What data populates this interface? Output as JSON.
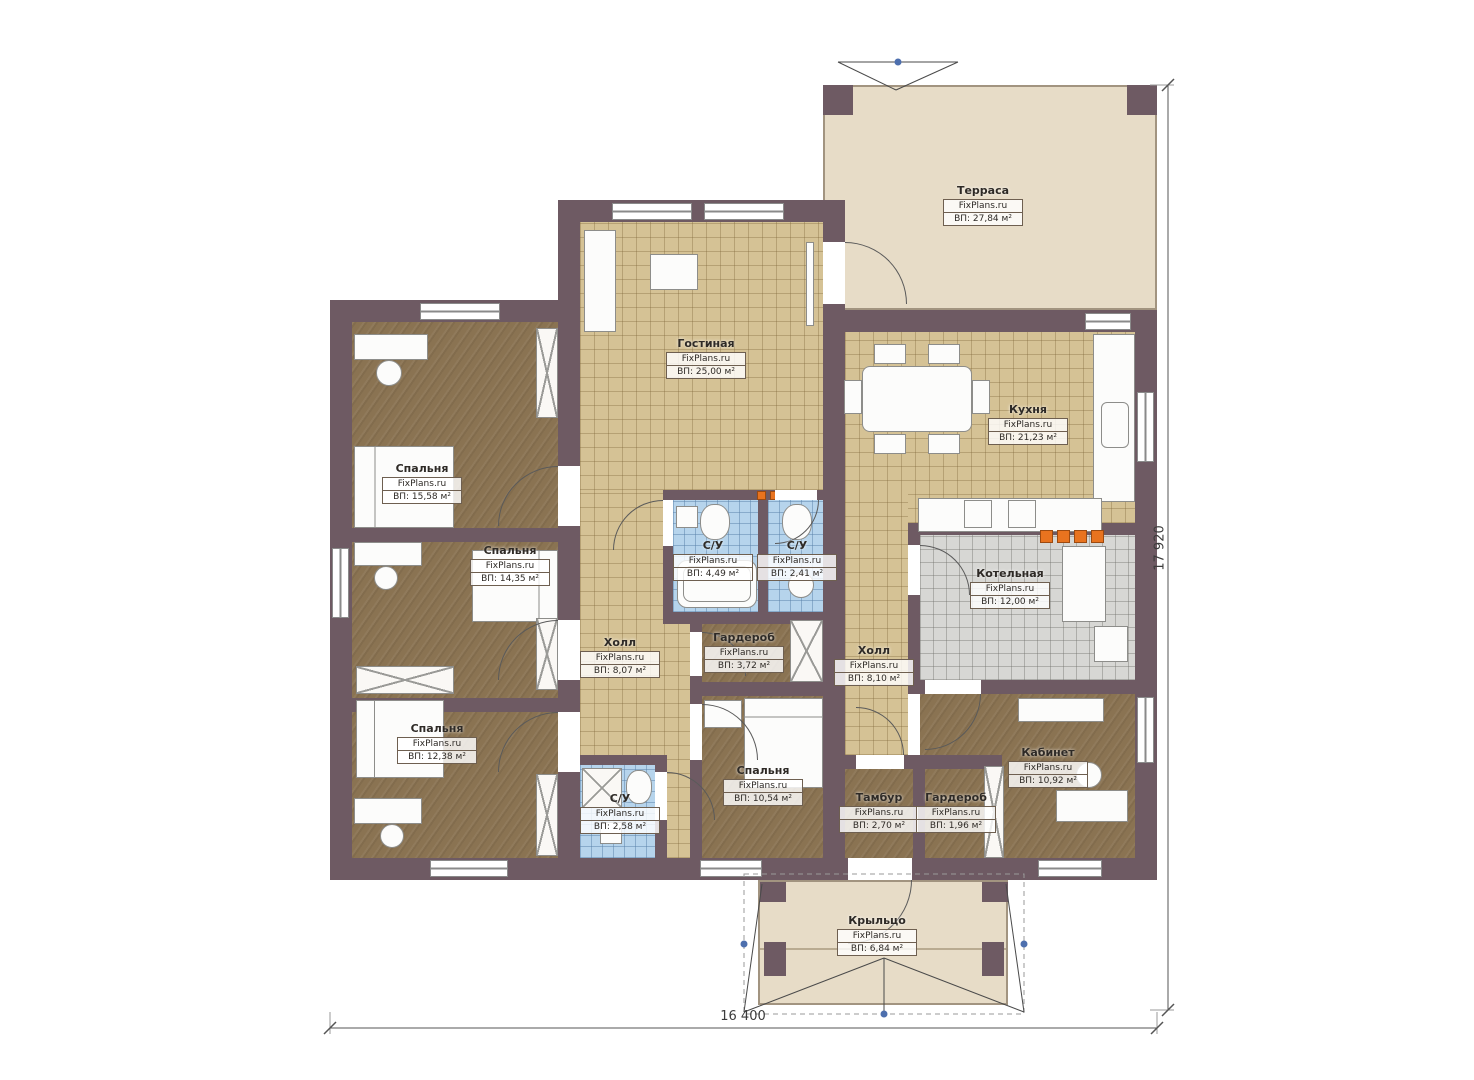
{
  "plan": {
    "brand": "FixPlans.ru",
    "rooms": [
      {
        "name": "Терраса",
        "area": "ВП: 27,84 м²"
      },
      {
        "name": "Гостиная",
        "area": "ВП: 25,00 м²"
      },
      {
        "name": "Кухня",
        "area": "ВП: 21,23 м²"
      },
      {
        "name": "Спальня",
        "area": "ВП: 15,58 м²"
      },
      {
        "name": "Спальня",
        "area": "ВП: 14,35 м²"
      },
      {
        "name": "Спальня",
        "area": "ВП: 12,38 м²"
      },
      {
        "name": "С/У",
        "area": "ВП: 4,49 м²"
      },
      {
        "name": "С/У",
        "area": "ВП: 2,41 м²"
      },
      {
        "name": "Холл",
        "area": "ВП: 8,07 м²"
      },
      {
        "name": "Гардероб",
        "area": "ВП: 3,72 м²"
      },
      {
        "name": "Холл",
        "area": "ВП: 8,10 м²"
      },
      {
        "name": "Котельная",
        "area": "ВП: 12,00 м²"
      },
      {
        "name": "Спальня",
        "area": "ВП: 10,54 м²"
      },
      {
        "name": "С/У",
        "area": "ВП: 2,58 м²"
      },
      {
        "name": "Тамбур",
        "area": "ВП: 2,70 м²"
      },
      {
        "name": "Гардероб",
        "area": "ВП: 1,96 м²"
      },
      {
        "name": "Кабинет",
        "area": "ВП: 10,92 м²"
      },
      {
        "name": "Крыльцо",
        "area": "ВП: 6,84 м²"
      }
    ],
    "dimensions": {
      "width_label": "16 400",
      "height_label": "17 920"
    },
    "colors": {
      "wall": "#6e5a63",
      "floor_tile": "#d5c295",
      "floor_wood": "#8a7352",
      "floor_bath": "#b6d4ec",
      "floor_boiler": "#d7d7d4",
      "floor_terrace": "#e7dcc7",
      "accent_orange": "#e8731f",
      "marker_blue": "#4d6fae"
    }
  }
}
